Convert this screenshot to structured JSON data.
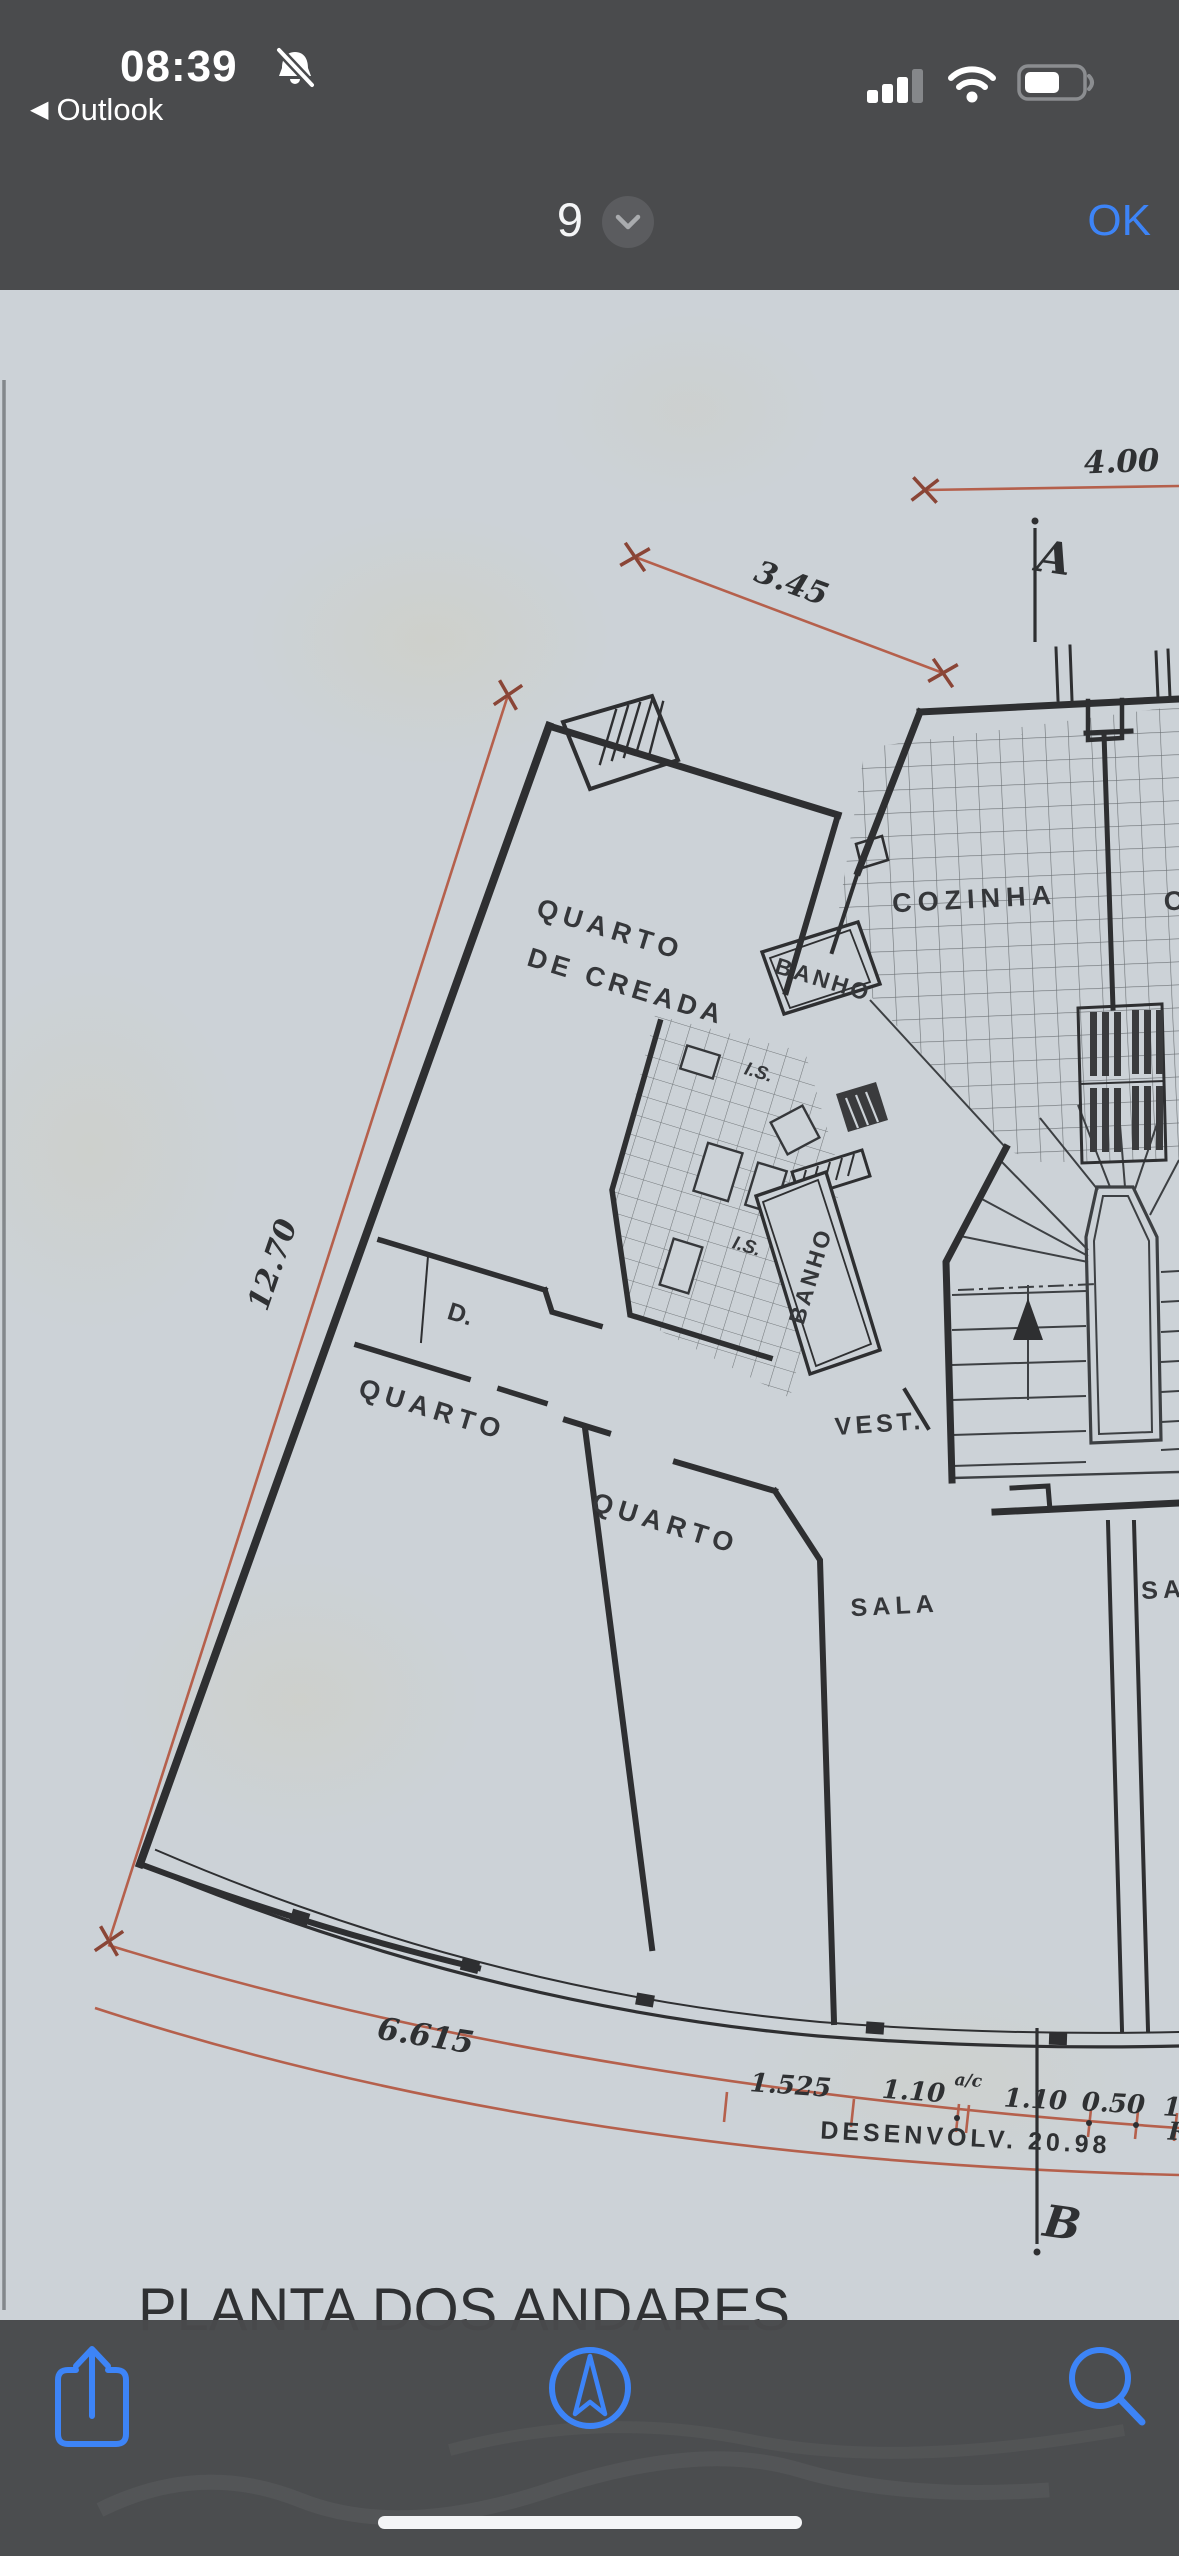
{
  "status_bar": {
    "time": "08:39",
    "back_label": "Outlook",
    "icons": {
      "notifications_muted": "bell-slash",
      "cell_signal": "3-of-4-bars",
      "wifi": "wifi",
      "battery": "battery-partial"
    }
  },
  "viewer_header": {
    "page_indicator": "9",
    "page_menu_icon": "chevron-down",
    "confirm_label": "OK"
  },
  "floor_plan": {
    "title": "PLANTA DOS ANDARES",
    "rooms": {
      "maid_room_line1": "QUARTO",
      "maid_room_line2": "DE CREADA",
      "bath_upper": "BANHO",
      "bath_lower": "BANHO",
      "wc_upper": "I.S.",
      "wc_lower": "I.S.",
      "kitchen": "COZINHA",
      "closet": "D.",
      "bedroom_left": "QUARTO",
      "bedroom_middle": "QUARTO",
      "vestibule": "VEST.",
      "living_room": "SALA",
      "living_room_adjacent_partial": "SA",
      "kitchen_adjacent_partial": "C"
    },
    "dimensions": {
      "top_width": "4.00",
      "upper_diagonal": "3.45",
      "left_length": "12.70",
      "facade_arc": "6.615",
      "facade_seg_1": "1.525",
      "facade_seg_2": "1.10",
      "facade_seg_2_note": "a/c",
      "facade_seg_3": "1.10",
      "facade_seg_4": "0.50",
      "facade_seg_5_partial": "1.",
      "development_note": "DESENVOLV. 20.98",
      "development_partial_right": "R"
    },
    "section_markers": {
      "top": "A",
      "bottom": "B"
    }
  },
  "toolbar": {
    "icons": [
      "share",
      "markup-compass",
      "search"
    ]
  },
  "colors": {
    "chrome": "#4a4b4d",
    "paper": "#cdd3d8",
    "ink": "#2e2f31",
    "red_dimension": "#b5604c",
    "ios_blue": "#3d84f7"
  }
}
